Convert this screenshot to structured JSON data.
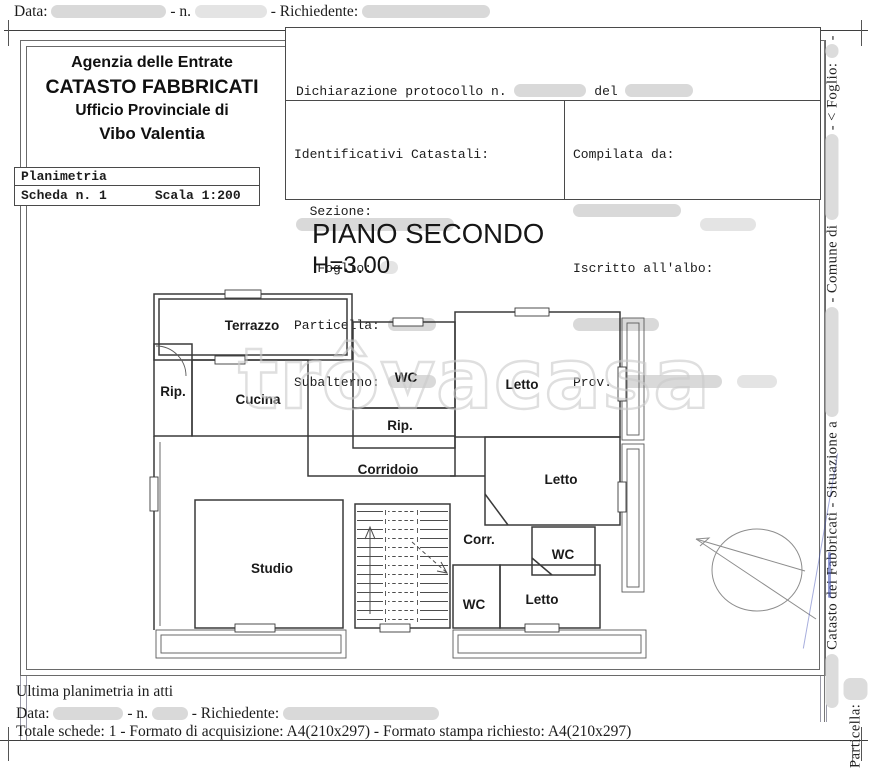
{
  "topbar": {
    "data_label": "Data:",
    "n_label": "- n.",
    "richiedente_label": "- Richiedente:"
  },
  "agency": {
    "line1": "Agenzia delle Entrate",
    "line2": "CATASTO FABBRICATI",
    "line3": "Ufficio Provinciale di",
    "line4": "Vibo Valentia"
  },
  "declaration": {
    "protocol_label": "Dichiarazione protocollo n.",
    "del_label": "del",
    "comune_label": "Comune di"
  },
  "identificativi": {
    "title": "Identificativi Catastali:",
    "sezione_label": "  Sezione:",
    "foglio_label": "   Foglio:",
    "particella_label": "Particella:",
    "subalterno_label": "Subalterno:"
  },
  "compilata": {
    "title": "Compilata da:",
    "albo_label": "Iscritto all'albo:",
    "prov_label": "Prov."
  },
  "planimetria": {
    "title": "Planimetria",
    "scheda": "Scheda n. 1",
    "scala": "Scala 1:200"
  },
  "plan": {
    "title": "PIANO SECONDO",
    "height_label": "H=3.00",
    "rooms": {
      "terrazzo": "Terrazzo",
      "rip_left": "Rip.",
      "cucina": "Cucina",
      "wc_top": "WC",
      "letto_top": "Letto",
      "rip_mid": "Rip.",
      "corridoio": "Corridoio",
      "letto_right": "Letto",
      "studio": "Studio",
      "corr": "Corr.",
      "wc_right": "WC",
      "wc_bottom": "WC",
      "letto_bottom": "Letto"
    }
  },
  "watermark": "trôvacasa",
  "side_strip": {
    "seg1": "Catasto dei Fabbricati - Situazione a",
    "seg2": "- Comune di",
    "seg3": "- < Foglio:",
    "seg4": "- Particella:"
  },
  "footer": {
    "ultima": "Ultima planimetria in atti",
    "data_label": "Data:",
    "n_label": "- n.",
    "richiedente_label": "- Richiedente:",
    "totale": "Totale schede: 1 - Formato di acquisizione: A4(210x297)  - Formato stampa richiesto: A4(210x297)"
  }
}
